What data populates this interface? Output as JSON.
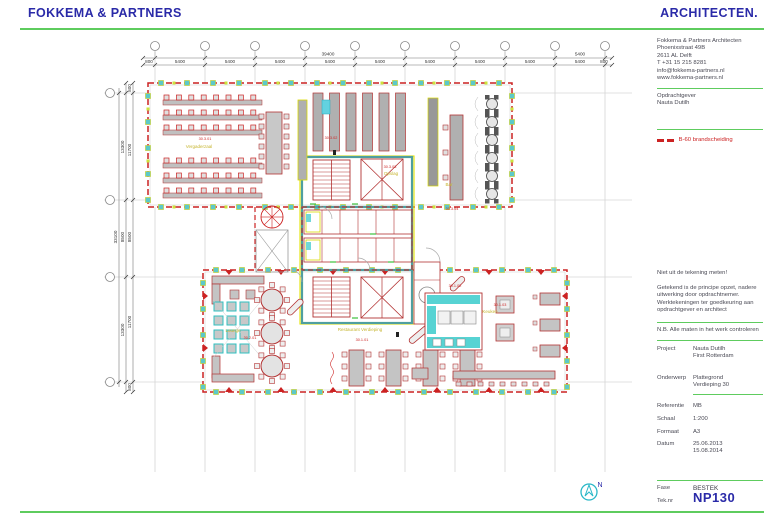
{
  "header": {
    "brand_left": "FOKKEMA & PARTNERS",
    "brand_right": "ARCHITECTEN."
  },
  "sidebar": {
    "address": [
      "Fokkema & Partners Architecten",
      "Phoenixstraat 49B",
      "2611 AL Delft",
      "T +31 15 215 8281",
      "info@fokkema-partners.nl",
      "www.fokkema-partners.nl"
    ],
    "client_label": "Opdrachtgever",
    "client_name": "Nauta Dutilh",
    "legend_label": "B-60 brandscheiding",
    "note1": "Niet uit de tekening meten!",
    "note2": "Getekend is de principe opzet, nadere uitwerking door opdrachtnemer. Werktekeningen ter goedkeuring aan opdrachtgever en architect",
    "note3": "N.B. Alle maten in het werk controleren",
    "fields": {
      "project_label": "Project",
      "project_value1": "Nauta Dutilh",
      "project_value2": "First Rotterdam",
      "onderwerp_label": "Onderwerp",
      "onderwerp_value1": "Plattegrond",
      "onderwerp_value2": "Verdieping 30",
      "referentie_label": "Referentie",
      "referentie_value": "MB",
      "schaal_label": "Schaal",
      "schaal_value": "1:200",
      "formaat_label": "Formaat",
      "formaat_value": "A3",
      "datum_label": "Datum",
      "datum_value1": "25.06.2013",
      "datum_value2": "15.08.2014",
      "fase_label": "Fase",
      "fase_value": "BESTEK",
      "teknr_label": "Tek.nr",
      "teknr_value": "NP130"
    }
  },
  "compass": {
    "label": "N"
  },
  "plan": {
    "colors": {
      "fire_line": "#cc2222",
      "wall_teal": "#4f9f9f",
      "accent_yellow": "#e3e300",
      "grid": "#d6d6d6",
      "green_rule": "#5ecc5e"
    },
    "dim_top": [
      {
        "t": "39400",
        "x": 328,
        "y": 55.5
      },
      {
        "t": "5400",
        "x": 580,
        "y": 55.5
      },
      {
        "t": "800",
        "x": 149,
        "y": 63
      },
      {
        "t": "5400",
        "x": 180,
        "y": 63
      },
      {
        "t": "5400",
        "x": 230,
        "y": 63
      },
      {
        "t": "5400",
        "x": 280,
        "y": 63
      },
      {
        "t": "5400",
        "x": 330,
        "y": 63
      },
      {
        "t": "5400",
        "x": 380,
        "y": 63
      },
      {
        "t": "5400",
        "x": 430,
        "y": 63
      },
      {
        "t": "5400",
        "x": 480,
        "y": 63
      },
      {
        "t": "5400",
        "x": 530,
        "y": 63
      },
      {
        "t": "5400",
        "x": 580,
        "y": 63
      },
      {
        "t": "800",
        "x": 604,
        "y": 63
      }
    ],
    "dim_left": [
      {
        "t": "33100",
        "x": 117,
        "y": 237
      },
      {
        "t": "13300",
        "x": 124,
        "y": 147
      },
      {
        "t": "8500",
        "x": 124,
        "y": 237
      },
      {
        "t": "13300",
        "x": 124,
        "y": 330
      },
      {
        "t": "800",
        "x": 131,
        "y": 88
      },
      {
        "t": "11700",
        "x": 131,
        "y": 150
      },
      {
        "t": "8500",
        "x": 131,
        "y": 237
      },
      {
        "t": "11700",
        "x": 131,
        "y": 322
      },
      {
        "t": "800",
        "x": 131,
        "y": 387
      }
    ],
    "area_labels": [
      {
        "t": "Vergaderzaal",
        "x": 199,
        "y": 148
      },
      {
        "t": "Bar",
        "x": 449,
        "y": 186
      },
      {
        "t": "Opslag",
        "x": 391,
        "y": 175
      },
      {
        "t": "Lounge",
        "x": 233,
        "y": 332
      },
      {
        "t": "Restaurant Verdieping",
        "x": 360,
        "y": 331
      },
      {
        "t": "Keuken",
        "x": 490,
        "y": 313
      }
    ],
    "room_codes": [
      {
        "t": "30.3.01",
        "x": 205,
        "y": 140
      },
      {
        "t": "30.3.02",
        "x": 331,
        "y": 139
      },
      {
        "t": "30.3.03",
        "x": 390,
        "y": 168
      },
      {
        "t": "30.3.04",
        "x": 452,
        "y": 210
      },
      {
        "t": "30.2.01",
        "x": 250,
        "y": 339
      },
      {
        "t": "30.1.01",
        "x": 362,
        "y": 341
      },
      {
        "t": "30.1.02",
        "x": 455,
        "y": 287
      },
      {
        "t": "30.1.03",
        "x": 500,
        "y": 306
      }
    ]
  }
}
